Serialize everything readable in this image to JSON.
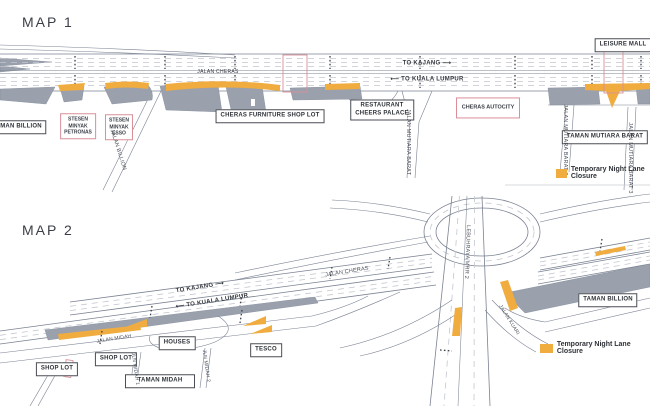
{
  "colors": {
    "closure": "#F0AC3E",
    "gray": "#9AA1AD",
    "road_edge": "#7A8292",
    "lane": "#C2C7D0",
    "pink": "#D98F98",
    "ink": "#2E3237"
  },
  "map1": {
    "title": "MAP 1",
    "road_labels": {
      "jalan_cheras": "JALAN CHERAS",
      "to_kajang": "TO KAJANG ⟶",
      "to_kl": "⟵ TO KUALA LUMPUR"
    },
    "places": {
      "leisure_mall": "LEISURE MALL",
      "taman_billion": "TAMAN BILLION",
      "cheras_furniture": "CHERAS FURNITURE SHOP LOT",
      "restaurant": "RESTAURANT\nCHEERS PALACE",
      "cheras_autocity": "CHERAS AUTOCITY",
      "petronas": "STESEN\nMINYAK\nPETRONAS",
      "esso": "STESEN\nMINYAK\nESSO",
      "taman_mutiara_barat": "TAMAN MUTIARA BARAT"
    },
    "streets": {
      "mutiara_barat": "JALAN MUTIARA BARAT",
      "mutiara_barat_2": "JALAN MUTIARA BARAT 2",
      "mutiara_barat_3": "JALAN MUTIARA BARAT 3",
      "billion": "JALAN BILLION"
    },
    "legend": "Temporary Night Lane Closure"
  },
  "map2": {
    "title": "MAP 2",
    "road_labels": {
      "to_kajang": "TO KAJANG ⟶",
      "to_kl": "⟵ TO KUALA LUMPUR",
      "jalan_cheras": "JALAN CHERAS",
      "highway": "LEBUHRAYA MRR 2"
    },
    "places": {
      "shop_lot_1": "SHOP LOT",
      "shop_lot_2": "SHOP LOT",
      "houses": "HOUSES",
      "tesco": "TESCO",
      "taman_midah": "TAMAN MIDAH",
      "taman_billion": "TAMAN BILLION"
    },
    "streets": {
      "midah": "JALAN MIDAH",
      "midah_1": "JLN MIDAH 1",
      "midah_2": "JLN MIDAH 2",
      "kuari": "JALAN KUARI"
    },
    "legend": "Temporary Night Lane Closure"
  }
}
